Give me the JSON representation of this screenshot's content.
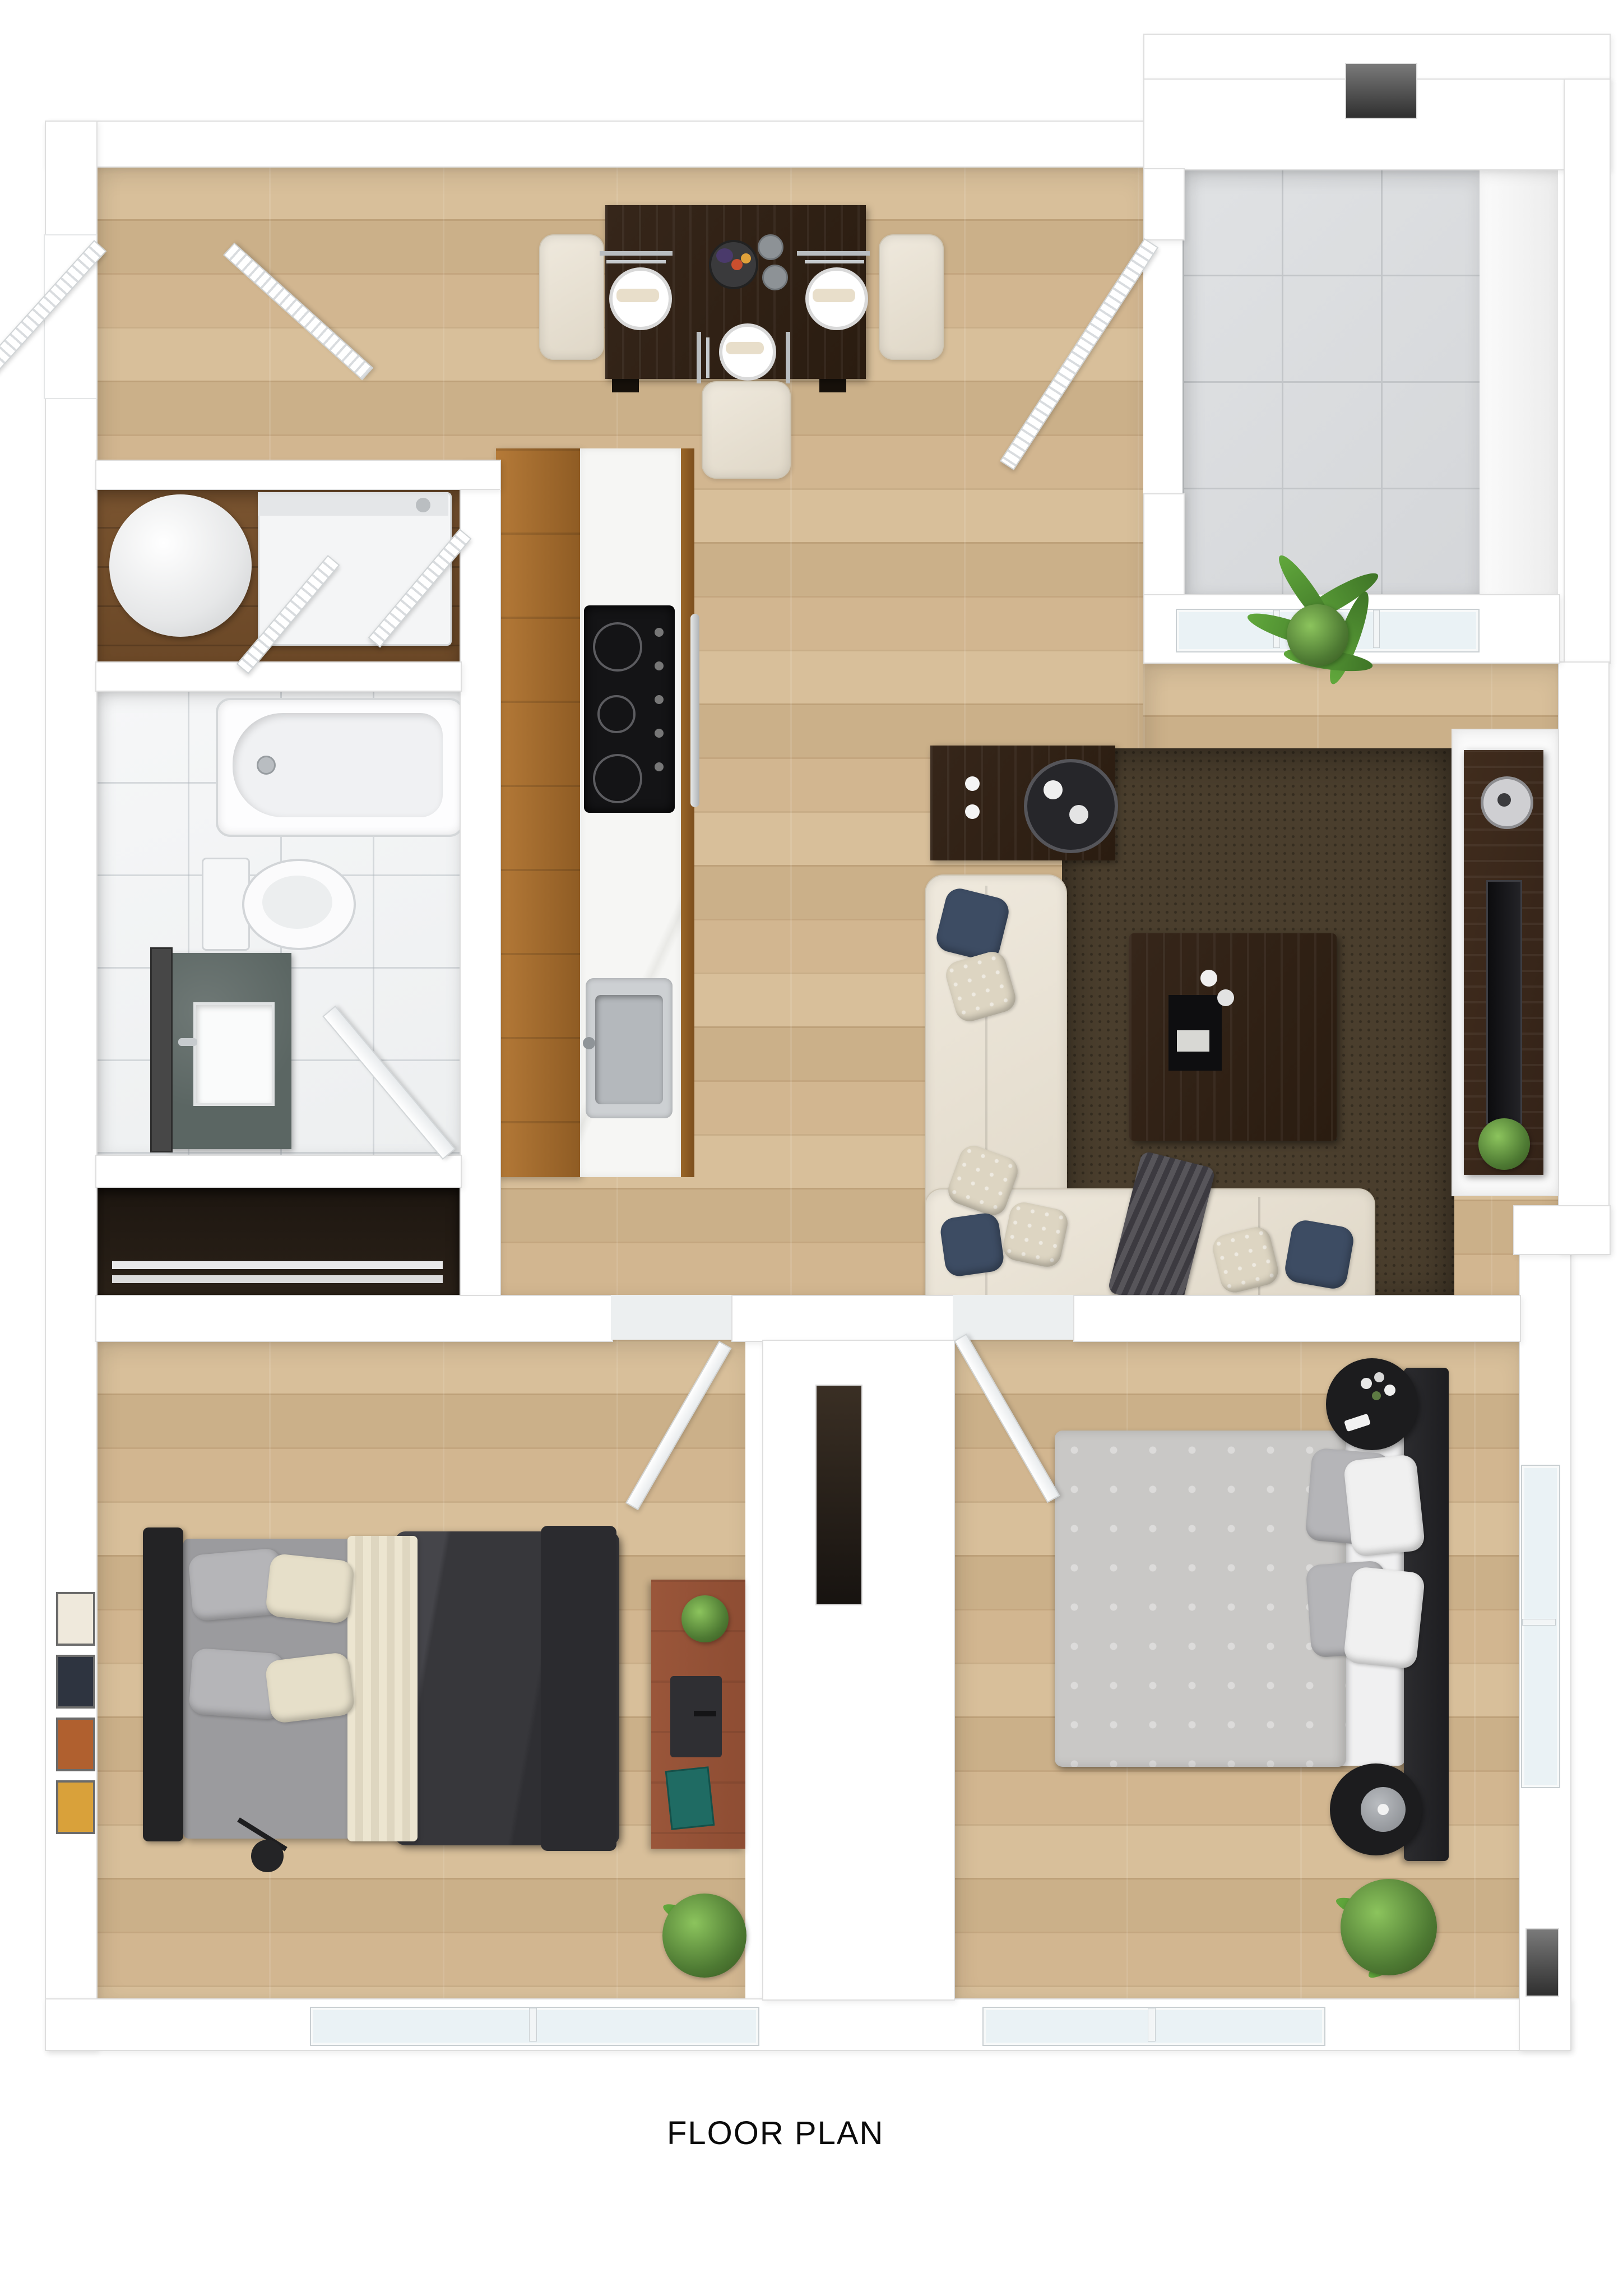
{
  "title": {
    "label": "FLOOR PLAN"
  },
  "palette": {
    "wall": "#ffffff",
    "wall-edge": "#dedede",
    "wood-light": "#d8bf9a",
    "wood-mid": "#cbb089",
    "tile": "#d4d6d9",
    "tile-line": "#c2c5c8",
    "bath-tile": "#edeff0",
    "dark-closet": "#2a2118",
    "espresso": "#2a1c10",
    "cream": "#dfd7c7",
    "navy": "#3d4c63",
    "charcoal": "#39393d",
    "rug": "#4a3e2d",
    "tv-wood": "#342318",
    "desk-wood": "#8e4d33",
    "plant": "#4e7a33",
    "marble": "#f5f5f3",
    "glass": "#eaf2f5"
  },
  "rooms": [
    {
      "name": "entry"
    },
    {
      "name": "dining-area"
    },
    {
      "name": "kitchen"
    },
    {
      "name": "living-room"
    },
    {
      "name": "balcony"
    },
    {
      "name": "utility-closet"
    },
    {
      "name": "bathroom"
    },
    {
      "name": "linen-closet"
    },
    {
      "name": "hallway"
    },
    {
      "name": "bedroom-1"
    },
    {
      "name": "bedroom-2"
    },
    {
      "name": "walk-in-closet"
    }
  ],
  "fixtures": [
    "dining-table",
    "dining-chairs",
    "place-settings",
    "fruit-bowl",
    "kitchen-counter",
    "cooktop",
    "oven",
    "kitchen-sink",
    "sectional-sofa",
    "area-rug",
    "coffee-table",
    "side-table",
    "tv-console",
    "tv",
    "speaker",
    "bathtub",
    "toilet",
    "vanity-sink",
    "mirror",
    "water-heater",
    "washing-machine",
    "bed",
    "headboard",
    "desk",
    "monitor",
    "book",
    "wall-art",
    "reading-lamp",
    "nightstand",
    "table-lamp",
    "potted-plants",
    "windows",
    "doors"
  ]
}
